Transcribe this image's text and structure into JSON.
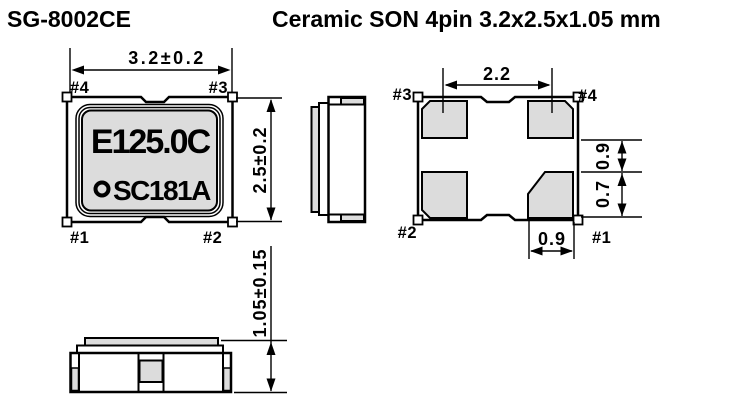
{
  "header": {
    "model": "SG-8002CE",
    "title": "Ceramic SON 4pin 3.2x2.5x1.05 mm"
  },
  "colors": {
    "pad_gray": "#dcdcdc",
    "line_black": "#000000",
    "background": "#ffffff"
  },
  "top_view": {
    "dim_width": "3.2±0.2",
    "dim_height": "2.5±0.2",
    "marking_line1": "E125.0C",
    "marking_line2": "SC181A",
    "pin_top_left": "#4",
    "pin_top_right": "#3",
    "pin_bottom_left": "#1",
    "pin_bottom_right": "#2"
  },
  "bottom_view": {
    "dim_pad_pitch": "2.2",
    "dim_pad_gap": "0.9",
    "dim_pad_height": "0.7",
    "dim_pad_width": "0.9",
    "pin_top_left": "#3",
    "pin_top_right": "#4",
    "pin_bottom_left": "#2",
    "pin_bottom_right": "#1"
  },
  "front_view": {
    "dim_height": "1.05±0.15"
  }
}
